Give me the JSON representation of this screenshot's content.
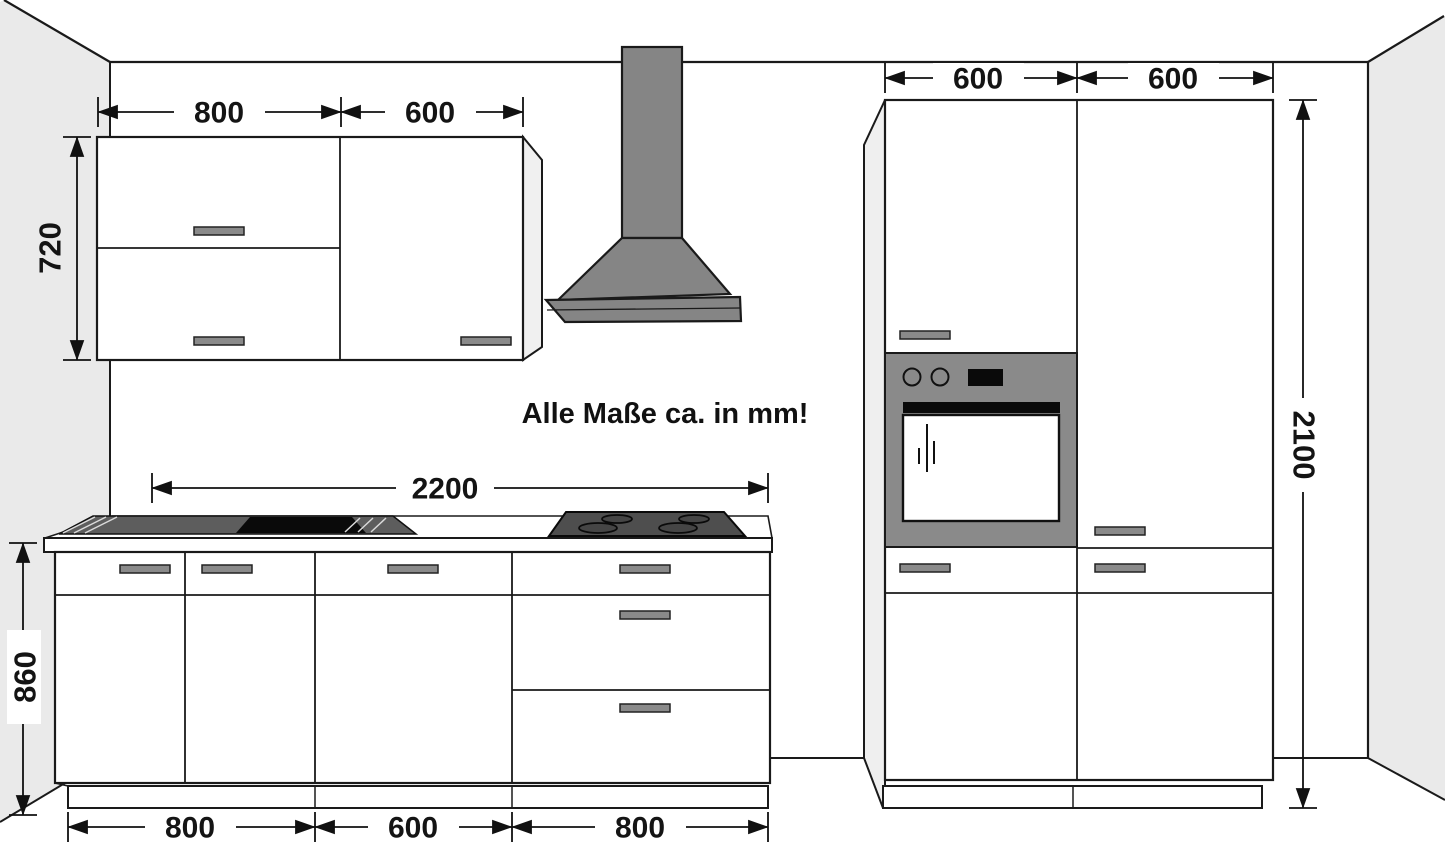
{
  "note": "Alle Maße ca. in mm!",
  "dimensions": {
    "wall_cabinets": {
      "width_left": "800",
      "width_right": "600",
      "height": "720"
    },
    "worktop_run": {
      "width": "2200"
    },
    "base_cabinets": {
      "height": "860",
      "widths": [
        "800",
        "600",
        "800"
      ]
    },
    "tall_cabinets": {
      "width_left": "600",
      "width_right": "600",
      "height": "2100"
    }
  },
  "colors": {
    "wall_shade": "#eaeaea",
    "line": "#1a1a1a",
    "hood_gray": "#858585",
    "oven_panel_gray": "#8a8a8a",
    "appliance_dark": "#4e4e4e",
    "sink_dark": "#5d5d5d",
    "black": "#0a0a0a",
    "handle_gray": "#8a8a8a",
    "side_panel": "#efefef"
  }
}
